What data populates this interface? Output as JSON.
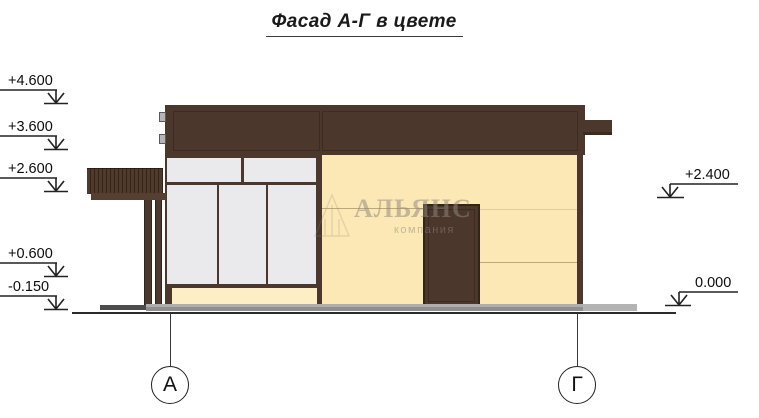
{
  "title": {
    "text": "Фасад А-Г в цвете"
  },
  "watermark": {
    "brand": "АЛЬЯНС",
    "tagline": "компания"
  },
  "levels": {
    "left": [
      {
        "value": "+4.600"
      },
      {
        "value": "+3.600"
      },
      {
        "value": "+2.600"
      },
      {
        "value": "+0.600"
      },
      {
        "value": "-0.150"
      }
    ],
    "right": [
      {
        "value": "+2.400"
      },
      {
        "value": "0.000"
      }
    ]
  },
  "axes": {
    "left": {
      "label": "А"
    },
    "right": {
      "label": "Г"
    }
  },
  "colors": {
    "dark_brown": "#4b372b",
    "brown_outline": "#362619",
    "wall_cream": "#fce8b4",
    "base_cream": "#fdeec6",
    "glass": "#eaeaec",
    "plinth_gray": "#9c9c9c",
    "plinth_dark": "#4c4c4c",
    "line": "#2b2b2b"
  }
}
